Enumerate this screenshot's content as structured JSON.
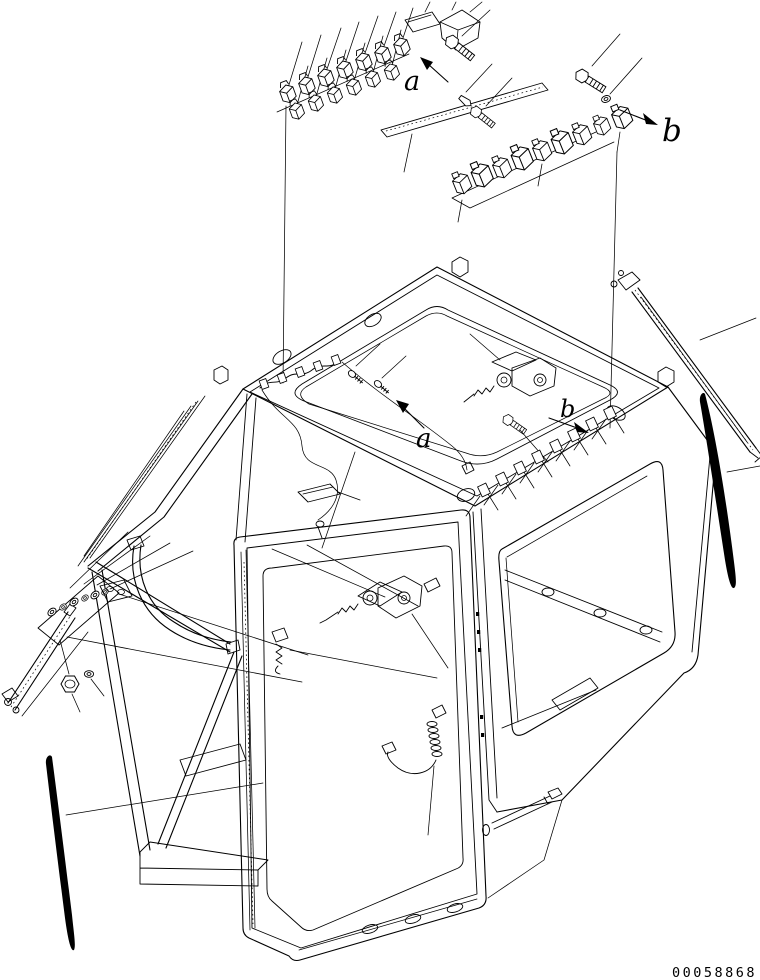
{
  "figure": {
    "background_color": "#ffffff",
    "line_color": "#000000",
    "callouts": {
      "top_a": "a",
      "top_b": "b",
      "roof_a": "a",
      "roof_b": "b"
    },
    "part_number": "00058868"
  }
}
